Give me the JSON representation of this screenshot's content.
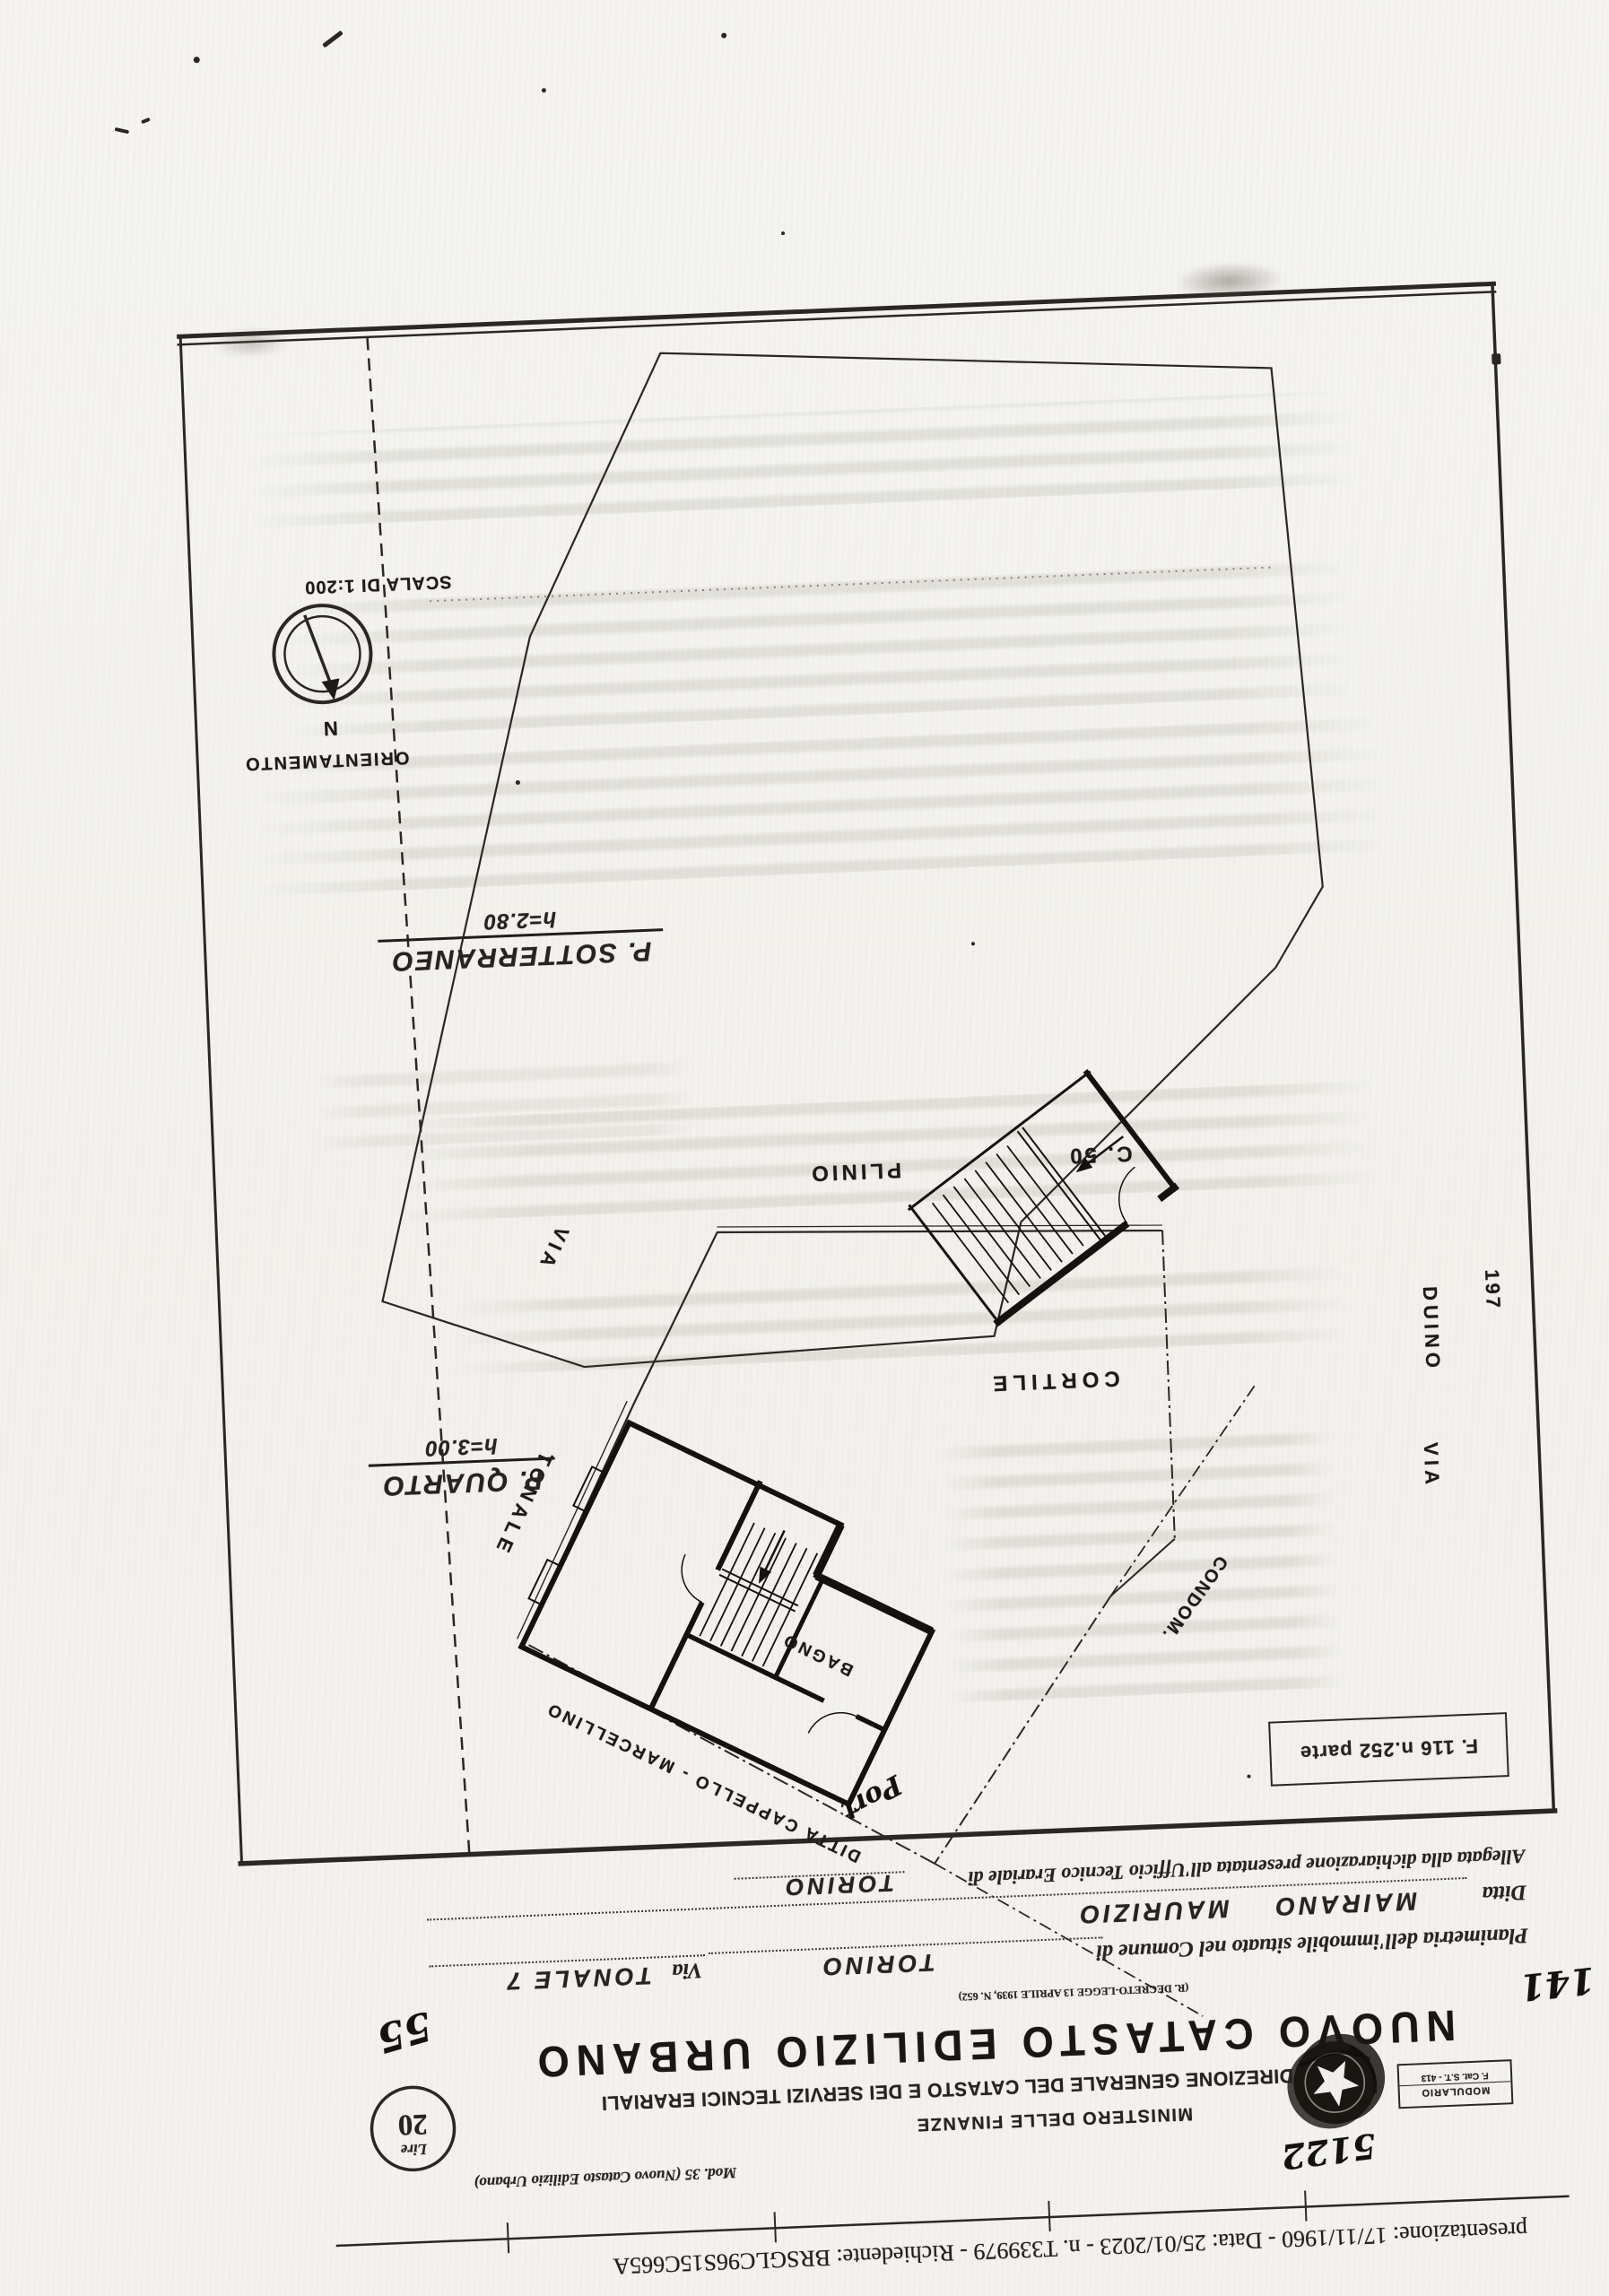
{
  "scan": {
    "presentation_line": "presentazione: 17/11/1960 - Data: 25/01/2023 - n. T339979 - Richiedente: BRSGLC96S15C665A"
  },
  "letterhead": {
    "modulario_top": "MODULARIO",
    "modulario_bottom": "F. Cat. S.T. - 413",
    "ministry": "MINISTERO DELLE FINANZE",
    "direction": "DIREZIONE GENERALE DEL CATASTO E DEI SERVIZI TECNICI ERARIALI",
    "title": "NUOVO CATASTO EDILIZIO URBANO",
    "decree": "(R. DECRETO-LEGGE 13 APRILE 1939, N. 652)",
    "mod_ref": "Mod. 35 (Nuovo Catasto Edilizio Urbano)",
    "lire_label": "Lire",
    "lire_value": "20"
  },
  "handwritten": {
    "protocol": "5122",
    "sheet_no": "141",
    "page_no": "55",
    "port": "Port"
  },
  "form": {
    "planimetria_label": "Planimetria dell'immobile situato nel Comune di",
    "comune": "TORINO",
    "via_label": "Via",
    "via_value": "TONALE 7",
    "ditta_label": "Ditta",
    "ditta_value": "MAIRANO MAURIZIO",
    "allegata_label": "Allegata alla dichiarazione presentata all'Ufficio Tecnico Erariale di",
    "allegata_value": "TORINO"
  },
  "map": {
    "sheet_ref": "F. 116 n.252 parte",
    "floor_upper": {
      "name": "P. QUARTO",
      "height": "h=3.00"
    },
    "floor_lower": {
      "name": "P. SOTTERRANEO",
      "height": "h=2.80"
    },
    "compass": {
      "title": "ORIENTAMENTO",
      "north": "N",
      "scale": "SCALA DI 1:200"
    },
    "labels": {
      "street_tonale": "TONALE",
      "street_tonale_via": "VIA",
      "street_duino_via": "VIA",
      "street_duino": "DUINO",
      "street_duino_civic": "197",
      "street_plinio": "PLINIO",
      "civic_c50": "C. 50",
      "cortile": "CORTILE",
      "bagno": "BAGNO",
      "condominio": "CONDOM.",
      "neighbor": "DITTA CAPPELLO - MARCELLINO"
    }
  }
}
